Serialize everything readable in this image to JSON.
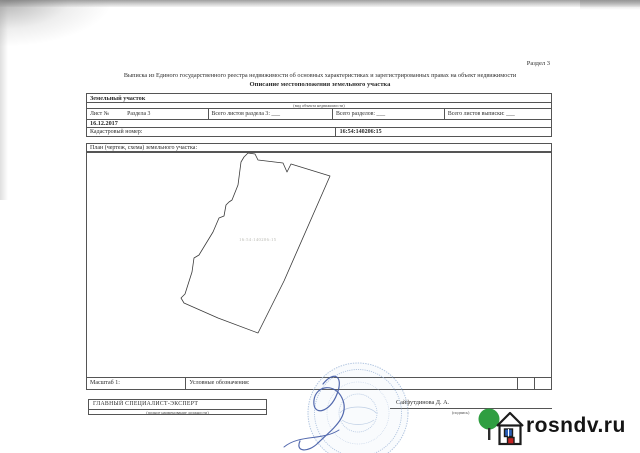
{
  "page": {
    "section_label": "Раздел 3"
  },
  "header": {
    "title_line1": "Выписка из Единого государственного реестра недвижимости об основных характеристиках и зарегистрированных правах на объект недвижимости",
    "title_line2": "Описание местоположения земельного участка"
  },
  "info_table": {
    "object_type": "Земельный участок",
    "object_type_note": "(вид объекта недвижимости)",
    "sheet_label": "Лист №",
    "sheet_section": "Раздела 3",
    "sheets_total_label": "Всего листов раздела 3: ___",
    "sections_total_label": "Всего разделов: ___",
    "extract_sheets_label": "Всего листов выписки: ___",
    "date": "16.12.2017",
    "cadastral_label": "Кадастровый номер:",
    "cadastral_value": "16:54:140206:15"
  },
  "plan": {
    "label": "План (чертеж, схема) земельного участка:",
    "parcel_label": "16:54:140206:15",
    "polygon_points": "241,162 244,157 248,153 255,154 258,160 283,163 287,172 291,164 330,176 284,281 258,333 218,318 184,303 181,298 185,294 192,272 194,258 199,255 213,232 219,218 224,216 226,205 229,202 232,200 238,185",
    "scale_label": "Масштаб 1:",
    "legend_label": "Условные обозначения:"
  },
  "signature_block": {
    "position_title": "ГЛАВНЫЙ СПЕЦИАЛИСТ-ЭКСПЕРТ",
    "position_note": "(полное наименование должности)",
    "signer_name": "Сайфутдинова Д. А.",
    "signer_note": "(подпись)"
  },
  "watermark": {
    "logo_text": "rosndv.ru"
  },
  "colors": {
    "stamp_blue": "#a9bfdd",
    "signature_blue": "#3c55a3",
    "plot_line": "#3a3a3a",
    "logo_green": "#2f9e41",
    "logo_red": "#c32222",
    "logo_window_blue": "#2b5fb8"
  }
}
